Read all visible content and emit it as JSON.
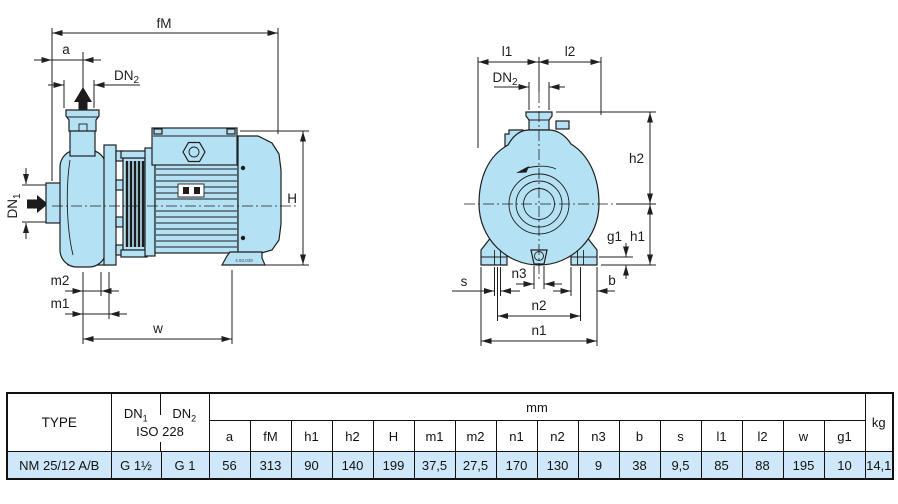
{
  "colors": {
    "body_fill": "#b5e1f4",
    "line": "#1f1f1f",
    "row_bg": "#cfe8f9"
  },
  "side_view": {
    "fm": "fM",
    "a": "a",
    "dn2": {
      "base": "DN",
      "sub": "2"
    },
    "dn1": {
      "base": "DN",
      "sub": "1"
    },
    "h": "H",
    "m2": "m2",
    "m1": "m1",
    "w": "w",
    "part_no": "4.93.038"
  },
  "front_view": {
    "l1": "l1",
    "l2": "l2",
    "dn2": {
      "base": "DN",
      "sub": "2"
    },
    "h2": "h2",
    "h1": "h1",
    "g1": "g1",
    "n3": "n3",
    "s": "s",
    "b": "b",
    "n2": "n2",
    "n1": "n1"
  },
  "table": {
    "type_header": "TYPE",
    "dn1_header": {
      "base": "DN",
      "sub": "1"
    },
    "dn2_header": {
      "base": "DN",
      "sub": "2"
    },
    "iso_header": "ISO 228",
    "mm_header": "mm",
    "kg_header": "kg",
    "dim_headers": [
      "a",
      "fM",
      "h1",
      "h2",
      "H",
      "m1",
      "m2",
      "n1",
      "n2",
      "n3",
      "b",
      "s",
      "l1",
      "l2",
      "w",
      "g1"
    ],
    "row": {
      "type": "NM 25/12 A/B",
      "dn1": "G 1½",
      "dn2": "G 1",
      "values": [
        "56",
        "313",
        "90",
        "140",
        "199",
        "37,5",
        "27,5",
        "170",
        "130",
        "9",
        "38",
        "9,5",
        "85",
        "88",
        "195",
        "10"
      ],
      "kg": "14,1"
    }
  }
}
